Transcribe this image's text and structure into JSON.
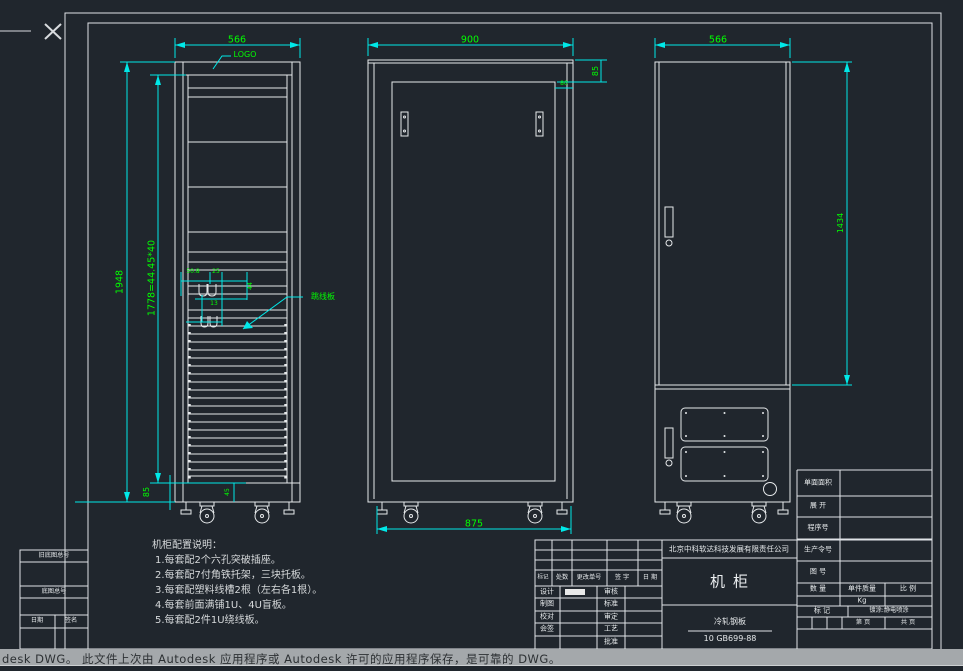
{
  "app": {
    "status_message": "desk DWG。  此文件上次由 Autodesk 应用程序或 Autodesk 许可的应用程序保存，是可靠的 DWG。"
  },
  "front": {
    "width_dim": "566",
    "logo_label": "LOGO",
    "height_dim": "1948",
    "rack_dim": "1778=44.45*40",
    "base_dim": "85",
    "base_inner_dim": "45",
    "detail_dims": [
      "50.8",
      "25",
      "44",
      "13"
    ],
    "jumper_label": "跳线板"
  },
  "middle": {
    "width_dim": "900",
    "top_dim": "85",
    "offset_dim": "80",
    "wheelbase_dim": "875"
  },
  "rear": {
    "width_dim": "566",
    "height_dim": "1434"
  },
  "notes": {
    "title": "机柜配置说明：",
    "items": [
      "1.每套配2个六孔突破插座。",
      "2.每套配7付角铁托架，三块托板。",
      "3.每套配塑料线槽2根（左右各1根）。",
      "4.每套前面满铺1U、4U盲板。",
      "5.每套配2件1U绕线板。"
    ]
  },
  "margin_table": {
    "old_base_label": "旧底图总号",
    "base_label": "底图总号",
    "date_label": "日期",
    "sign_label": "签名"
  },
  "title_block": {
    "company": "北京中科软达科技发展有限责任公司",
    "drawing_title": "机柜",
    "material_name": "冷轧钢板",
    "material_std": "10  GB699-88",
    "rev_headers": [
      "标记",
      "处数",
      "更改单号",
      "签 字",
      "日 期"
    ],
    "sig_left": [
      "设计",
      "制图",
      "校对",
      "会签"
    ],
    "sig_right": [
      "审核",
      "标准",
      "审定",
      "工艺",
      "批准"
    ],
    "info_labels": [
      "单面面积",
      "展 开",
      "程序号",
      "生产令号",
      "图 号"
    ],
    "qty_headers": [
      "数 量",
      "单件质量",
      "比 例"
    ],
    "unit_weight": "Kg",
    "mark_label": "标 记",
    "coating": "镀涂:静电喷涂",
    "page": "第    页",
    "pages_total": "共    页"
  }
}
